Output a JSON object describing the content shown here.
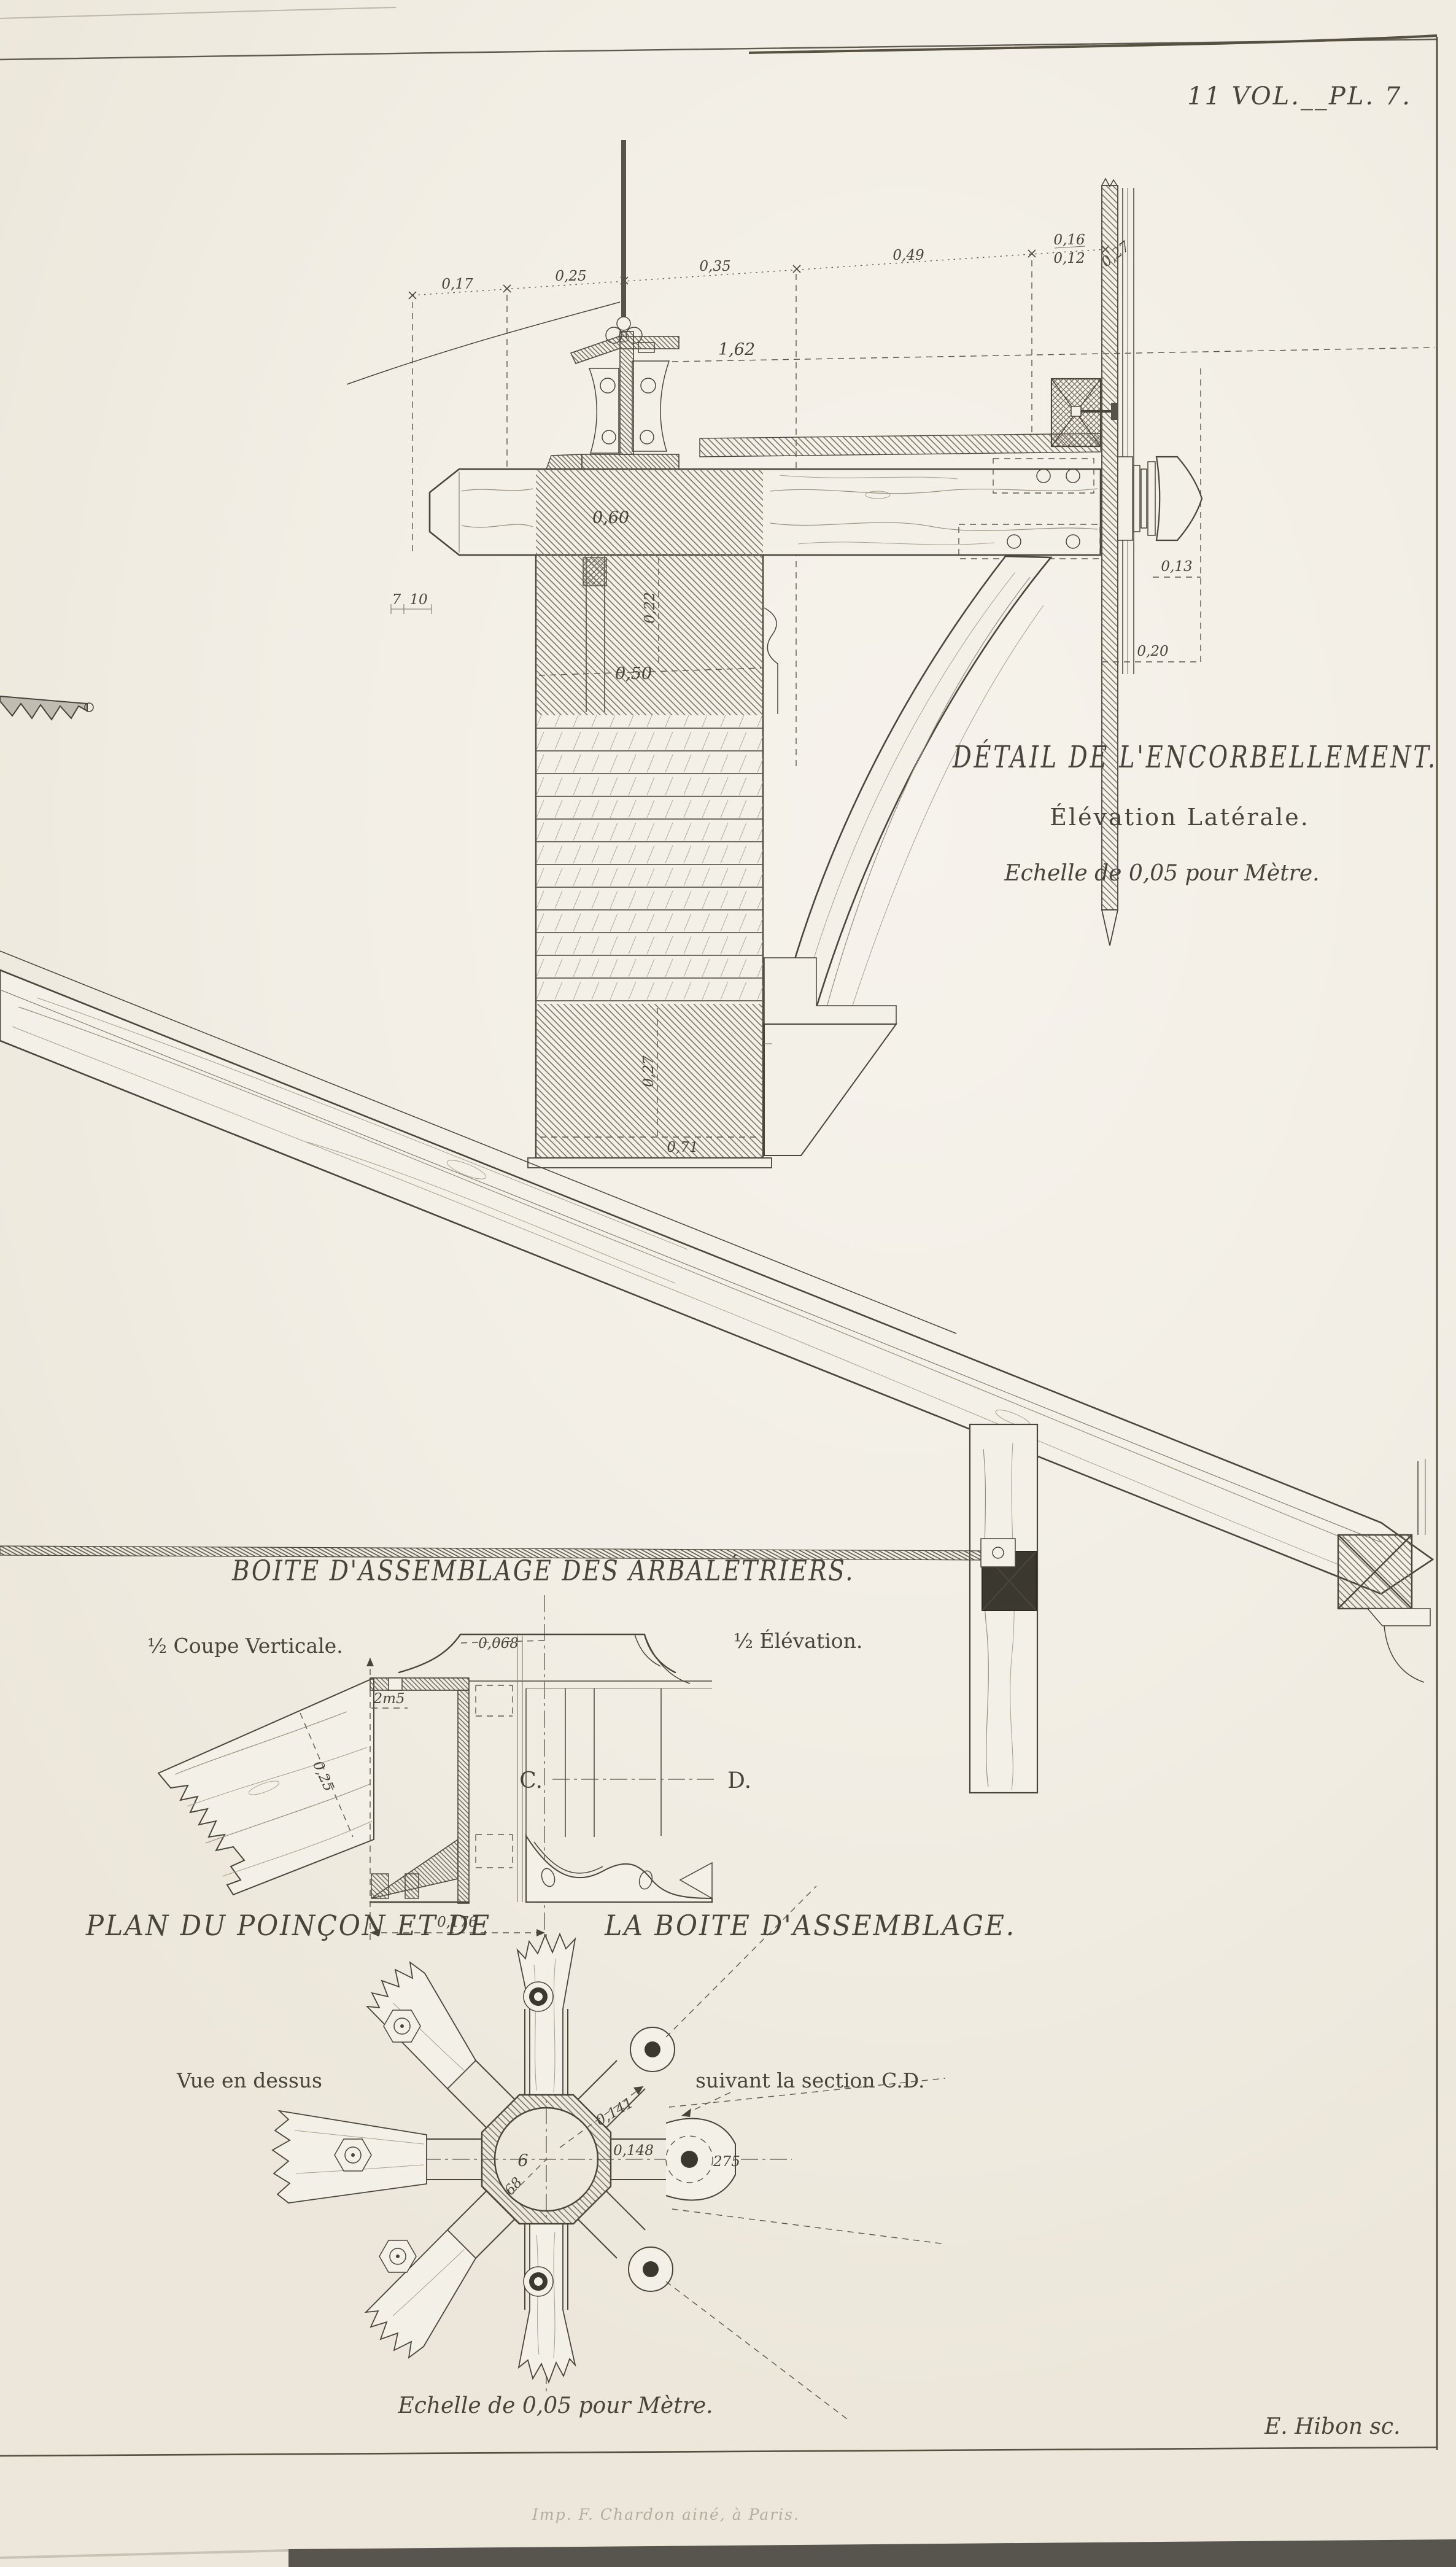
{
  "plate": {
    "number": "11 VOL.__PL. 7.",
    "engraver_credit": "E. Hibon sc.",
    "imprint": "Imp. F. Chardon ainé, à Paris."
  },
  "corbel": {
    "title": "DÉTAIL DE L'ENCORBELLEMENT.",
    "subtitle": "Élévation Latérale.",
    "scale_note": "Echelle de 0,05 pour Mètre.",
    "top_dims": [
      "0,17",
      "0,25",
      "0,35",
      "0,49",
      "0,16",
      "0,12",
      "0,27"
    ],
    "dims": {
      "ridge_height": "1,62",
      "beam_width": "0,60",
      "beam_depth": "0,22",
      "wall_band": "0,50",
      "knob_projection": "0,13",
      "knob_total": "0,20",
      "base_height": "0,27",
      "base_width": "0,71",
      "tick_a": "7",
      "tick_b": "10"
    }
  },
  "box": {
    "title": "BOITE D'ASSEMBLAGE DES ARBALÉTRIERS.",
    "left_view_label": "½ Coupe Verticale.",
    "right_view_label": "½ Élévation.",
    "section_c": "C.",
    "section_d": "D.",
    "dims": {
      "top_width": "0,068",
      "flange_lip": "2m5",
      "rafter_depth": "0,25",
      "base_width": "0,176"
    }
  },
  "plan": {
    "title_left": "PLAN DU POINÇON ET DE",
    "title_right": "LA BOITE D'ASSEMBLAGE.",
    "view_label_left": "Vue en dessus",
    "view_label_right": "suivant la section C.D.",
    "scale_note": "Echelle de 0,05 pour Mètre.",
    "dims": {
      "radius_upper": "0,141",
      "radius_right": "0,148",
      "hub_a": "6",
      "hub_b": "68",
      "bolt_note": "275"
    }
  }
}
